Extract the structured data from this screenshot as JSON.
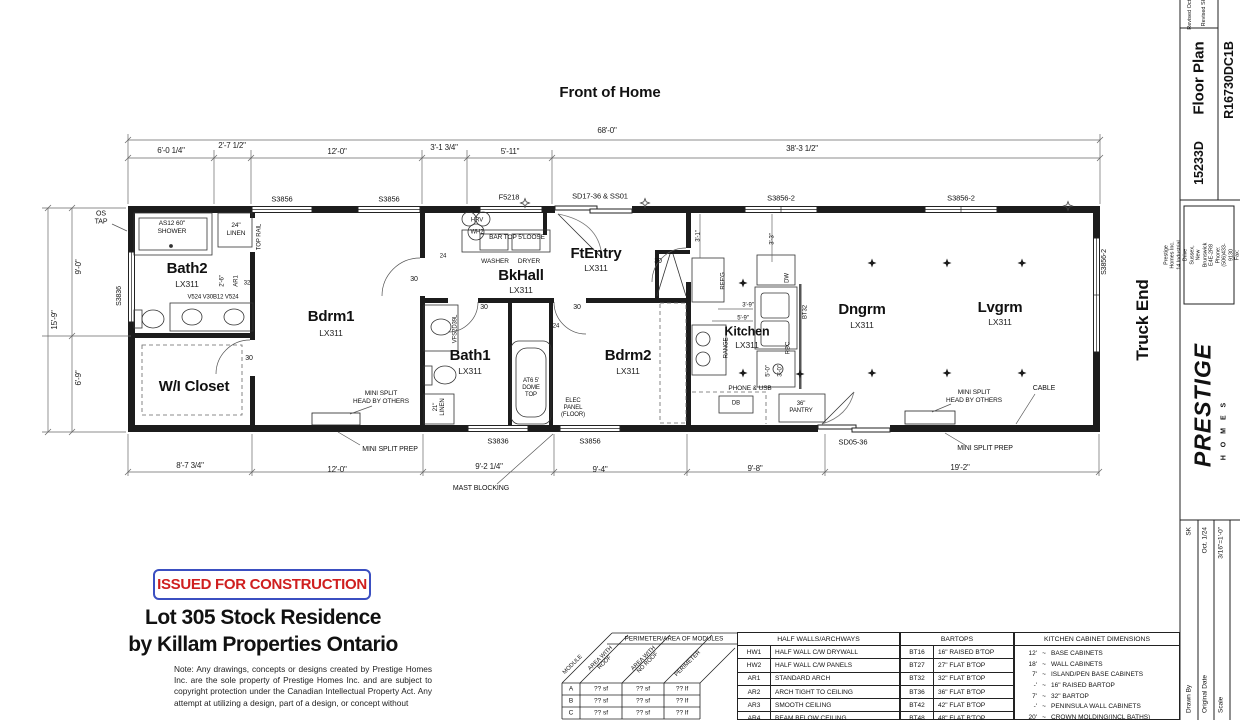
{
  "header": {
    "front_of_home": "Front of Home",
    "truck_end": "Truck End",
    "stamp": "ISSUED FOR CONSTRUCTION",
    "project_line1": "Lot 305 Stock Residence",
    "project_line2": "by Killam Properties Ontario",
    "note": "Note:  Any drawings, concepts or designs created by Prestige Homes Inc. are the sole property of Prestige Homes Inc. and are subject to copyright protection under the Canadian Intellectual Property Act. Any attempt at utilizing a design, part of a design, or concept without"
  },
  "dims": {
    "top_total": "68'-0\"",
    "top": [
      "6'-0 1/4\"",
      "2'-7 1/2\"",
      "12'-0\"",
      "3'-1 3/4\"",
      "5'-11\"",
      "38'-3 1/2\""
    ],
    "bottom": [
      "8'-7 3/4\"",
      "12'-0\"",
      "9'-2 1/4\"",
      "9'-4\"",
      "9'-8\"",
      "19'-2\""
    ],
    "left_total": "15'-9\"",
    "left_top": "9'-0\"",
    "left_bottom": "6'-9\"",
    "small": {
      "b2_arch": "2'-6\"",
      "k31": "3'-1\"",
      "k33": "3'-3\"",
      "k39": "3'-9\"",
      "k59": "5'-9\"",
      "k50": "5'-0\"",
      "k30": "3'-0\""
    }
  },
  "windows": {
    "top": [
      "S3856",
      "S3856",
      "F5218",
      "SD17-36 & SS01",
      "S3856-2",
      "S3856-2"
    ],
    "left": "S3836",
    "right": "S3856-2",
    "bottom": [
      "S3836",
      "S3856",
      "SD05-36"
    ]
  },
  "rooms": {
    "bath2": {
      "name": "Bath2",
      "model": "LX311"
    },
    "bdrm1": {
      "name": "Bdrm1",
      "model": "LX311"
    },
    "wic": {
      "name": "W/I Closet"
    },
    "bath1": {
      "name": "Bath1",
      "model": "LX311"
    },
    "bkhall": {
      "name": "BkHall",
      "model": "LX311"
    },
    "ftentry": {
      "name": "FtEntry",
      "model": "LX311"
    },
    "bdrm2": {
      "name": "Bdrm2",
      "model": "LX311"
    },
    "kitchen": {
      "name": "Kitchen",
      "model": "LX311"
    },
    "dngrm": {
      "name": "Dngrm",
      "model": "LX311"
    },
    "lvgrm": {
      "name": "Lvgrm",
      "model": "LX311"
    }
  },
  "fx": {
    "os_tap": "OS\nTAP",
    "shower": "AS12 60\"\nSHOWER",
    "linen24": "24\"\nLINEN",
    "top_rail": "TOP RAIL",
    "ar1": "AR1",
    "ar1_size": "32",
    "vanity_codes": "V524  V30B12  V524",
    "hrv": "HRV",
    "wh2": "WH2",
    "bar_top": "BAR TOP 5'LOOSE",
    "washer": "WASHER",
    "dryer": "DRYER",
    "vfs": "VFS2D39L",
    "linen21": "21\"\nLINEN",
    "tub": "AT6 5'\nDOME\nTOP",
    "elec": "ELEC\nPANEL\n(FLOOR)",
    "refg": "REF'G",
    "dw": "DW",
    "bt32": "BT32",
    "rbc": "RBC",
    "range": "RANGE",
    "phone": "PHONE & USB",
    "db": "DB",
    "pantry": "36\"\nPANTRY",
    "mini_split_head": "MINI SPLIT\nHEAD BY OTHERS",
    "mini_split_prep": "MINI SPLIT PREP",
    "cable": "CABLE",
    "mast": "MAST BLOCKING",
    "d30": "30",
    "d24": "24"
  },
  "tables": {
    "modules": {
      "title": "PERIMETER/AREA OF MODULES",
      "cols": [
        "MODULE",
        "AREA WITH\nROOF",
        "AREA WITH\nNO ROOF",
        "PERIMETER"
      ],
      "rows": [
        [
          "A",
          "?? sf",
          "?? sf",
          "?? lf"
        ],
        [
          "B",
          "?? sf",
          "?? sf",
          "?? lf"
        ],
        [
          "C",
          "?? sf",
          "?? sf",
          "?? lf"
        ]
      ]
    },
    "half_walls": {
      "title": "HALF WALLS/ARCHWAYS",
      "rows": [
        [
          "HW1",
          "HALF WALL C/W DRYWALL"
        ],
        [
          "HW2",
          "HALF WALL C/W PANELS"
        ],
        [
          "AR1",
          "STANDARD ARCH"
        ],
        [
          "AR2",
          "ARCH TIGHT TO CEILING"
        ],
        [
          "AR3",
          "SMOOTH CEILING"
        ],
        [
          "AR4",
          "BEAM BELOW CEILING"
        ]
      ]
    },
    "bartops": {
      "title": "BARTOPS",
      "rows": [
        [
          "BT16",
          "16\" RAISED B'TOP"
        ],
        [
          "BT27",
          "27\" FLAT B'TOP"
        ],
        [
          "BT32",
          "32\" FLAT B'TOP"
        ],
        [
          "BT36",
          "36\" FLAT B'TOP"
        ],
        [
          "BT42",
          "42\" FLAT B'TOP"
        ],
        [
          "BT48",
          "48\" FLAT B'TOP"
        ]
      ]
    },
    "kitchen": {
      "title": "KITCHEN CABINET DIMENSIONS",
      "tilde": "~",
      "rows": [
        [
          "12'",
          "BASE CABINETS"
        ],
        [
          "18'",
          "WALL CABINETS"
        ],
        [
          "7'",
          "ISLAND/PEN BASE CABINETS"
        ],
        [
          "-'",
          "16\" RAISED BARTOP"
        ],
        [
          "7'",
          "32\" BARTOP"
        ],
        [
          "-'",
          "PENINSULA WALL CABINETS"
        ],
        [
          "20'",
          "CROWN MOLDING(INCL BATHS)"
        ]
      ]
    }
  },
  "titleblock": {
    "rev1": "Revised Oct.",
    "rev2": "Revised SK",
    "floor_plan": "Floor Plan",
    "model": "R16730DC1B",
    "serial": "15233D",
    "company": "Prestige Homes Inc.\n14 Industrial Drive\nSussex, New Brunswick\nE4E-2R8\nPhone: (506)433-9130\nFax: (506)433-9141",
    "logo": "PRESTIGE",
    "logo_sub": "H O M E S",
    "drawn_label": "Drawn By",
    "drawn": "SK",
    "date_label": "Original Date",
    "date": "Oct. 1/24",
    "scale_label": "Scale",
    "scale": "3/16\"=1'-0\""
  }
}
